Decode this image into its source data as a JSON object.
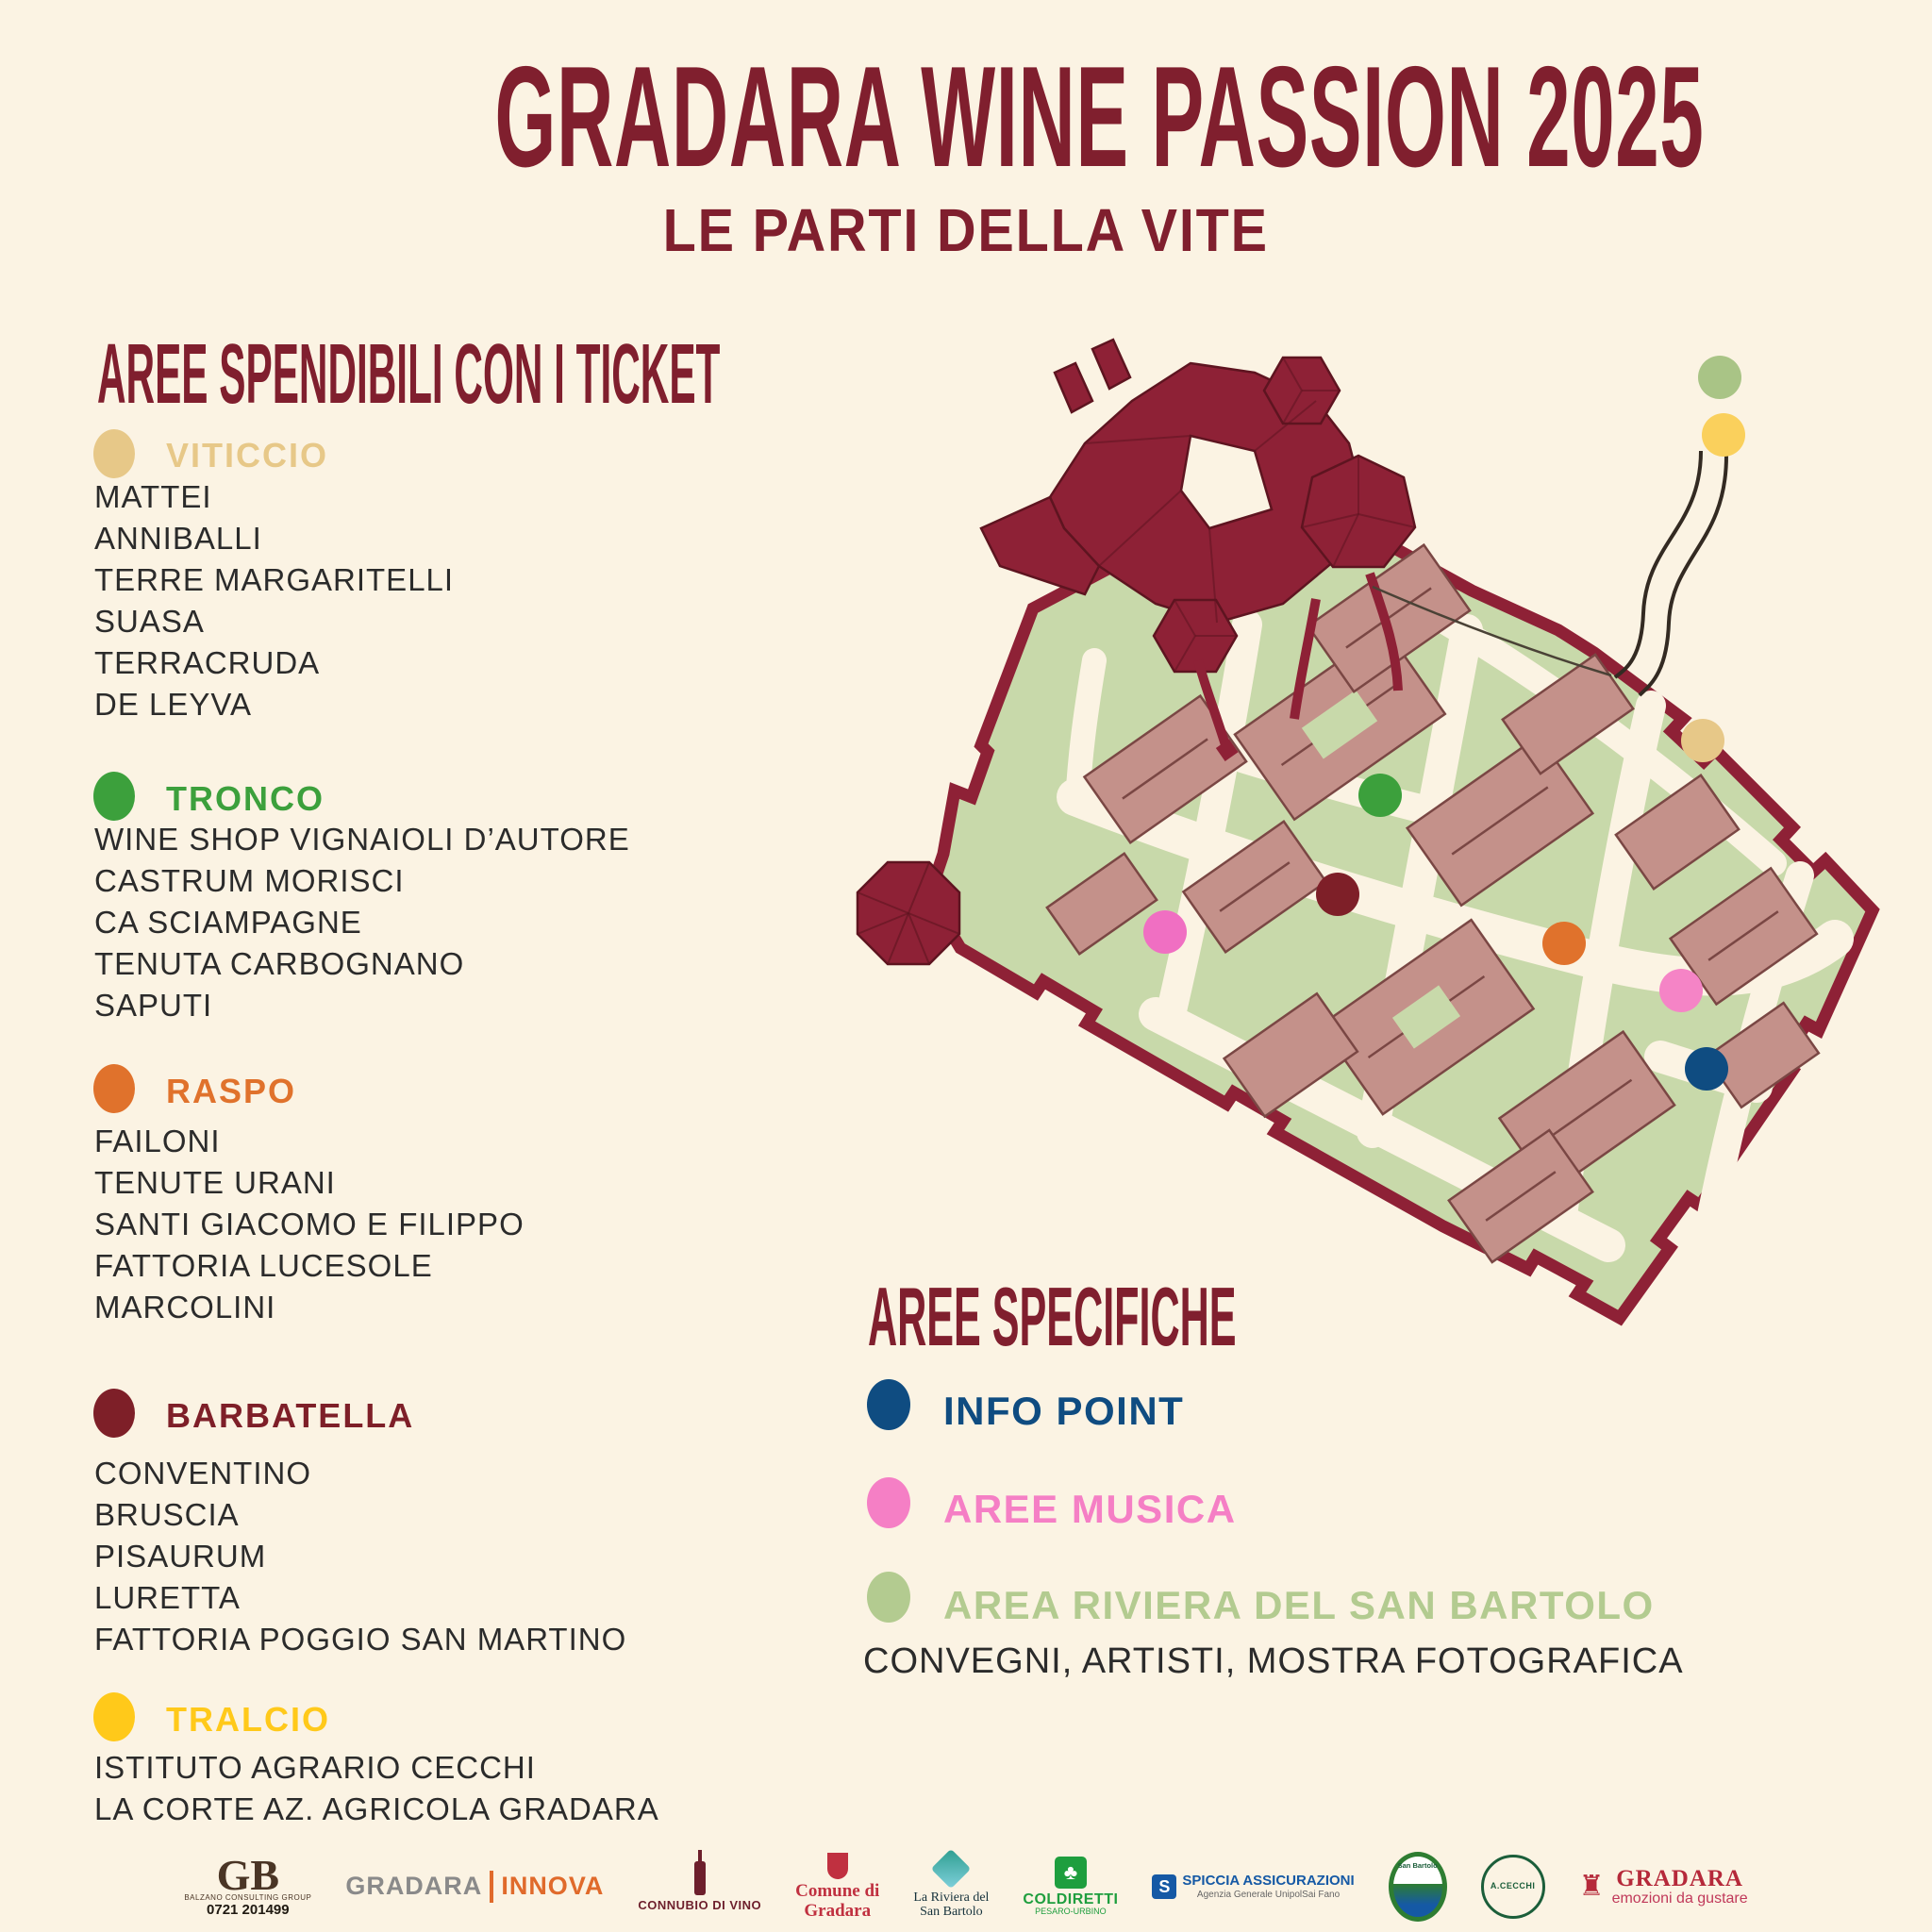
{
  "palette": {
    "background": "#FBF3E3",
    "primary": "#801F2E",
    "text": "#2B2B2B"
  },
  "header": {
    "title": "GRADARA WINE PASSION 2025",
    "subtitle": "LE PARTI DELLA VITE"
  },
  "ticket_areas": {
    "heading": "AREE SPENDIBILI CON I TICKET",
    "categories": [
      {
        "name": "VITICCIO",
        "color": "#E7C888",
        "items": [
          "MATTEI",
          "ANNIBALLI",
          "TERRE MARGARITELLI",
          "SUASA",
          "TERRACRUDA",
          "DE LEYVA"
        ]
      },
      {
        "name": "TRONCO",
        "color": "#3CA03C",
        "items": [
          "WINE SHOP VIGNAIOLI D’AUTORE",
          "CASTRUM MORISCI",
          "CA SCIAMPAGNE",
          "TENUTA CARBOGNANO",
          "SAPUTI"
        ]
      },
      {
        "name": "RASPO",
        "color": "#E0722C",
        "items": [
          "FAILONI",
          "TENUTE URANI",
          "SANTI GIACOMO E FILIPPO",
          "FATTORIA LUCESOLE",
          "MARCOLINI"
        ]
      },
      {
        "name": "BARBATELLA",
        "color": "#7E1F28",
        "items": [
          "CONVENTINO",
          "BRUSCIA",
          "PISAURUM",
          "LURETTA",
          "FATTORIA POGGIO SAN MARTINO"
        ]
      },
      {
        "name": "TRALCIO",
        "color": "#FFC91A",
        "items": [
          "ISTITUTO AGRARIO CECCHI",
          "LA CORTE AZ. AGRICOLA GRADARA"
        ]
      }
    ]
  },
  "specific_areas": {
    "heading": "AREE SPECIFICHE",
    "items": [
      {
        "name": "INFO POINT",
        "color": "#0F4C81"
      },
      {
        "name": "AREE MUSICA",
        "color": "#F57FC5"
      },
      {
        "name": "AREA RIVIERA DEL SAN BARTOLO",
        "color": "#B3CB90"
      }
    ],
    "note": "CONVEGNI, ARTISTI, MOSTRA FOTOGRAFICA"
  },
  "map": {
    "markers": [
      {
        "name": "area-riviera-marker",
        "color": "#A9C486"
      },
      {
        "name": "tralcio-marker",
        "color": "#FAD05C"
      },
      {
        "name": "viticcio-marker",
        "color": "#E7C888"
      },
      {
        "name": "tronco-marker",
        "color": "#3CA03C"
      },
      {
        "name": "barbatella-marker",
        "color": "#7E1F28"
      },
      {
        "name": "aree-musica-marker-1",
        "color": "#F06FC2"
      },
      {
        "name": "raspo-marker",
        "color": "#E0722C"
      },
      {
        "name": "aree-musica-marker-2",
        "color": "#F584C6"
      },
      {
        "name": "info-point-marker",
        "color": "#0F4C81"
      }
    ]
  },
  "footer": {
    "logos": [
      {
        "id": "balzano-consulting-group",
        "text": "GB",
        "sub": "BALZANO CONSULTING GROUP",
        "phone": "0721 201499"
      },
      {
        "id": "gradara-innova",
        "text": "GRADARA",
        "sub": "INNOVA"
      },
      {
        "id": "connubio-di-vino",
        "text": "CONNUBIO DI VINO"
      },
      {
        "id": "comune-di-gradara",
        "text": "Comune di",
        "sub": "Gradara"
      },
      {
        "id": "la-riviera-del-san-bartolo",
        "text": "La Riviera del",
        "sub": "San Bartolo"
      },
      {
        "id": "coldiretti",
        "text": "COLDIRETTI",
        "sub": "PESARO-URBINO",
        "icon_glyph": "♣"
      },
      {
        "id": "spiccia-assicurazioni",
        "text": "SPICCIA ASSICURAZIONI",
        "sub": "Agenzia Generale UnipolSai Fano",
        "icon_glyph": "S"
      },
      {
        "id": "parco-naturale-san-bartolo",
        "text": "San Bartolo"
      },
      {
        "id": "istituto-cecchi",
        "text": "A.CECCHI"
      },
      {
        "id": "gradara-emozioni-da-gustare",
        "text": "GRADARA",
        "sub": "emozioni da gustare",
        "icon_glyph": "♜"
      }
    ]
  }
}
